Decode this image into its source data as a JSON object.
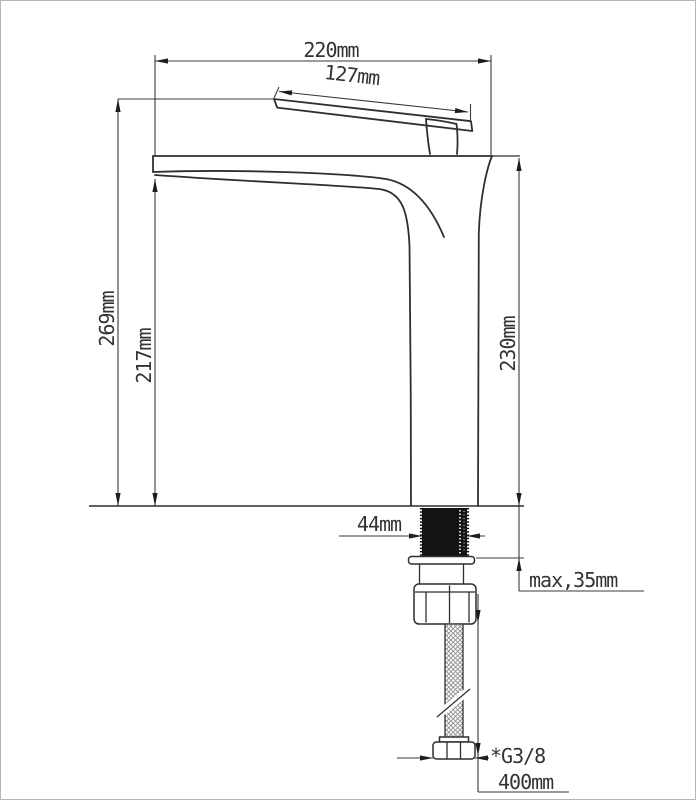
{
  "drawing": {
    "description": "Technical dimension drawing, side elevation of a tall single-lever basin mixer faucet with flexible supply hose",
    "background_color": "#ffffff",
    "line_color": "#2f2f2f",
    "labels": {
      "total_width": "220mm",
      "handle_length": "127mm",
      "total_height": "269mm",
      "spout_height": "217mm",
      "body_height": "230mm",
      "stem_width": "44mm",
      "max_counter_thickness": "max,35mm",
      "thread_size": "*G3/8",
      "hose_length": "400mm"
    }
  }
}
